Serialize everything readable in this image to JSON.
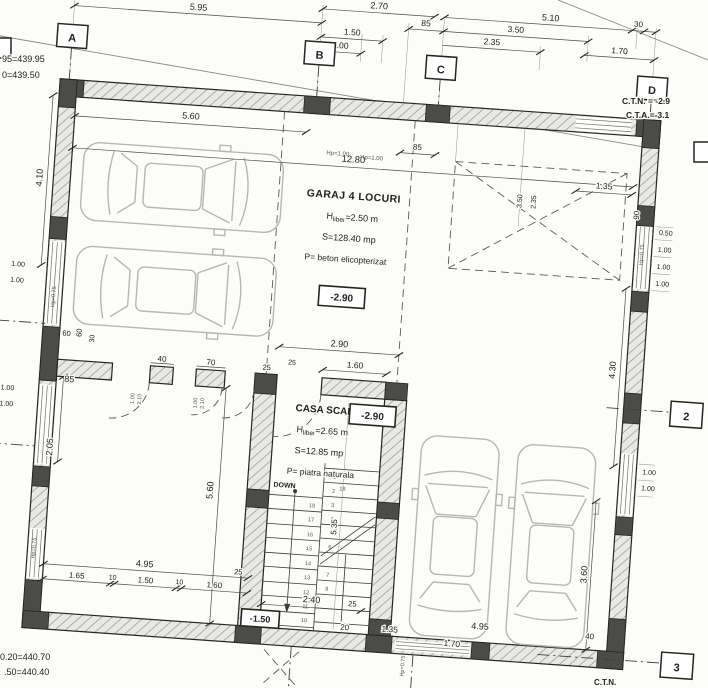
{
  "drawing": {
    "axes": {
      "A": "A",
      "B": "B",
      "C": "C",
      "D": "D",
      "r2": "2",
      "r3": "3"
    },
    "levels": {
      "tl1": "95=439.95",
      "tl2": "0=439.50",
      "tr1": "C.T.N. = -2.9",
      "tr2": "C.T.A.=-3.1",
      "bl1": "0.20=440.70",
      "bl2": ".50=440.40",
      "br1": "C.T.N.",
      "garaj": "-2.90",
      "scara": "-2.90",
      "stair": "-1.50"
    },
    "rooms": {
      "garaj": {
        "title": "GARAJ 4 LOCURI",
        "h_pre": "H",
        "h_sub": "liber",
        "h_post": "=2.50 m",
        "area": "S=128.40 mp",
        "finish": "P= beton elicopterizat"
      },
      "scara": {
        "title": "CASA SCARII",
        "h_pre": "H",
        "h_sub": "liber",
        "h_post": "=2.65 m",
        "area": "S=12.85 mp",
        "finish": "P= piatra naturala"
      }
    },
    "stair": {
      "down": "DOWN",
      "entry": "18",
      "treads_left": [
        "18",
        "17",
        "16",
        "15",
        "14",
        "13",
        "12",
        "11",
        "10"
      ],
      "treads_right": [
        "1",
        "2",
        "3",
        "4",
        "5",
        "6",
        "7",
        "8"
      ]
    },
    "dims": {
      "top": [
        "5.95",
        "2.70",
        "1.50",
        "1.00",
        "85",
        "5.10",
        "3.50",
        "2.35",
        "30",
        "1.70"
      ],
      "inner_top": [
        "5.60",
        "12.80",
        "85",
        "Hp=1.00",
        "Hp=1.00",
        "3.50",
        "2.35",
        "1.35",
        "90"
      ],
      "left": [
        "4.10",
        "1.00",
        "1.00",
        "Hp=0.75",
        "60",
        "60",
        "30",
        "85",
        "1.00",
        "1.00",
        "2.05",
        "5.60",
        "Hp=0.75"
      ],
      "partition": [
        "40",
        "70",
        "25",
        "2.90",
        "25",
        "1.60",
        "1.00",
        "2.10",
        "1.00",
        "2.10"
      ],
      "right": [
        "0.50",
        "1.00",
        "1.00",
        "1.00",
        "Hp=0.75",
        "4.30",
        "1.00",
        "1.00",
        "3.60",
        "40"
      ],
      "bottom": [
        "4.95",
        "25",
        "1.65",
        "10",
        "1.50",
        "10",
        "1.60",
        "2.40",
        "20",
        "25",
        "1.35",
        "4.95",
        "1.70",
        "Hp=0.75"
      ],
      "stair_height": "5.35"
    }
  }
}
